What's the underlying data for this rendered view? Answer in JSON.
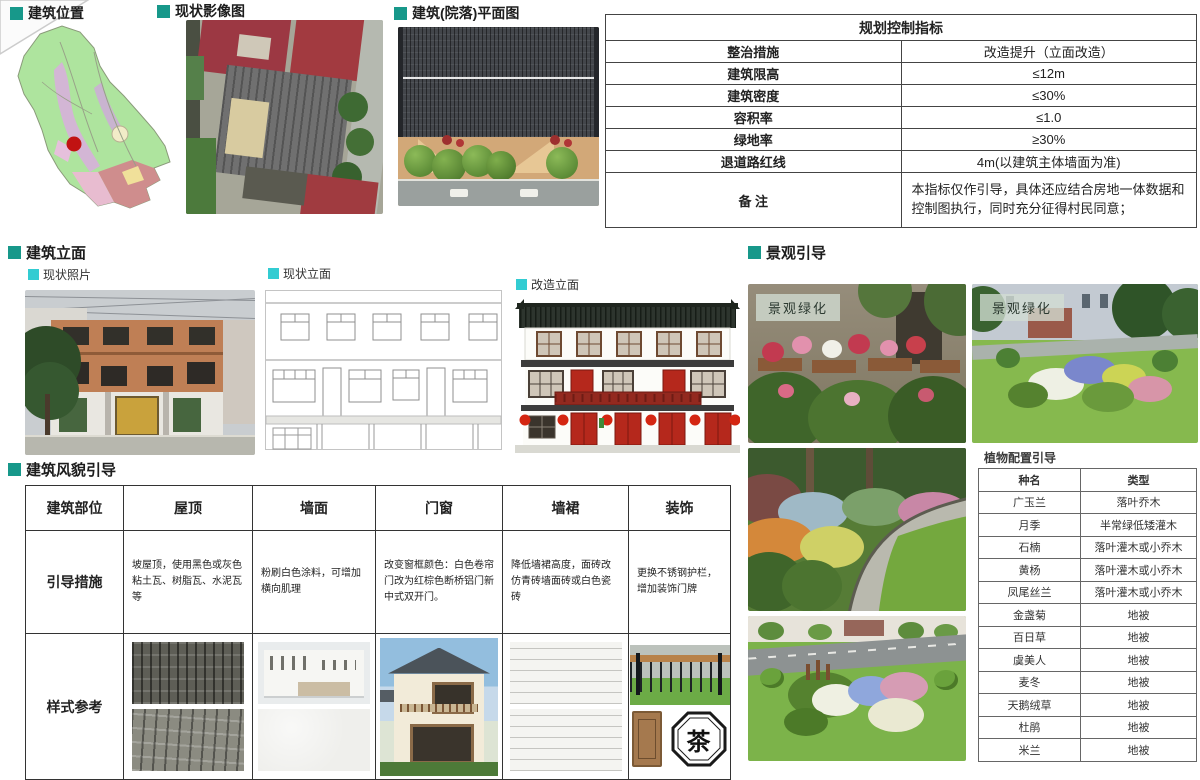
{
  "headers": {
    "building_location": "建筑位置",
    "current_imagery": "现状影像图",
    "building_plan": "建筑(院落)平面图",
    "building_elevation": "建筑立面",
    "current_photo": "现状照片",
    "current_elevation": "现状立面",
    "renovated_elevation": "改造立面",
    "landscape_guidance": "景观引导",
    "building_style_guidance": "建筑风貌引导",
    "plant_config_guidance": "植物配置引导"
  },
  "planning_table": {
    "title": "规划控制指标",
    "rows": [
      {
        "label": "整治措施",
        "value": "改造提升（立面改造）"
      },
      {
        "label": "建筑限高",
        "value": "≤12m"
      },
      {
        "label": "建筑密度",
        "value": "≤30%"
      },
      {
        "label": "容积率",
        "value": "≤1.0"
      },
      {
        "label": "绿地率",
        "value": "≥30%"
      },
      {
        "label": "退道路红线",
        "value": "4m(以建筑主体墙面为准)"
      },
      {
        "label": "备 注",
        "value": "本指标仅作引导，具体还应结合房地一体数据和控制图执行，同时充分征得村民同意；"
      }
    ]
  },
  "style_table": {
    "headers": [
      "建筑部位",
      "屋顶",
      "墙面",
      "门窗",
      "墙裙",
      "装饰"
    ],
    "guidance_row_label": "引导措施",
    "guidance": [
      "坡屋顶，使用黑色或灰色粘土瓦、树脂瓦、水泥瓦等",
      "粉刷白色涂料，可增加横向肌理",
      "改变窗框颜色：白色卷帘门改为红棕色断桥铝门新中式双开门。",
      "降低墙裙高度，面砖改仿青砖墙面砖或白色瓷砖",
      "更换不锈钢护栏，增加装饰门牌"
    ],
    "reference_row_label": "样式参考"
  },
  "plant_table": {
    "headers": [
      "种名",
      "类型"
    ],
    "rows": [
      [
        "广玉兰",
        "落叶乔木"
      ],
      [
        "月季",
        "半常绿低矮灌木"
      ],
      [
        "石楠",
        "落叶灌木或小乔木"
      ],
      [
        "黄杨",
        "落叶灌木或小乔木"
      ],
      [
        "凤尾丝兰",
        "落叶灌木或小乔木"
      ],
      [
        "金盏菊",
        "地被"
      ],
      [
        "百日草",
        "地被"
      ],
      [
        "虞美人",
        "地被"
      ],
      [
        "麦冬",
        "地被"
      ],
      [
        "天鹅绒草",
        "地被"
      ],
      [
        "杜鹃",
        "地被"
      ],
      [
        "米兰",
        "地被"
      ]
    ]
  },
  "landscape": {
    "label_a": "景观绿化",
    "label_b": "景观绿化"
  },
  "decor": {
    "tea_sign": "茶"
  },
  "colors": {
    "section_bullet": "#17988a",
    "sub_bullet": "#32ccd2",
    "map_marker": "#c11212",
    "renovation_door_red": "#b5281c"
  }
}
